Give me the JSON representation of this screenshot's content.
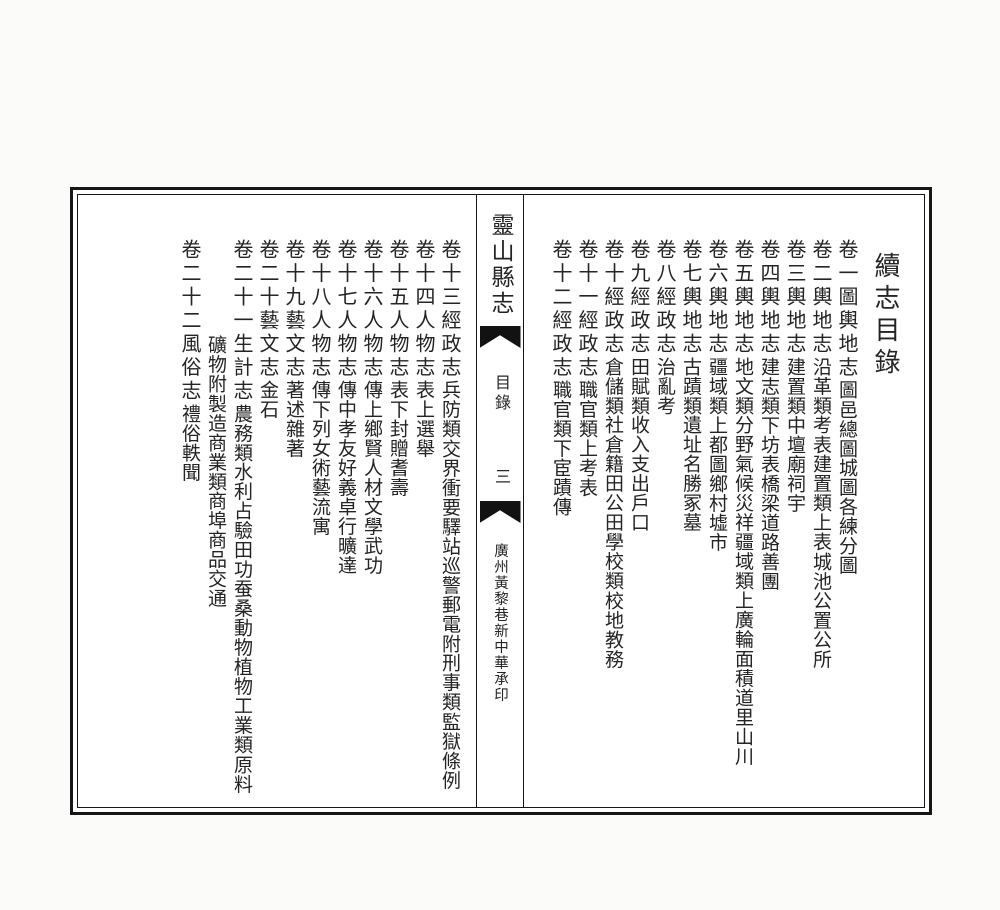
{
  "toc_title": "續志目錄",
  "banxin": {
    "book_title": "靈山縣志",
    "section_label": "目錄",
    "page_number": "三",
    "printer_imprint": "廣州黃黎巷新中華承印"
  },
  "right_page": {
    "entries": [
      {
        "volume": "卷一圖輿地志",
        "groups": [
          [
            "圖"
          ],
          [
            "邑總圖",
            "城圖",
            "各練分圖"
          ]
        ]
      },
      {
        "volume": "卷二輿地志",
        "groups": [
          [
            "沿革類"
          ],
          [
            "考",
            "表"
          ],
          [
            "建置類上"
          ],
          [
            "表",
            "城池",
            "公置",
            "公所"
          ]
        ]
      },
      {
        "volume": "卷三輿地志",
        "groups": [
          [
            "建置類中"
          ],
          [
            "壇廟",
            "祠宇"
          ]
        ]
      },
      {
        "volume": "卷四輿地志",
        "groups": [
          [
            "建志類下"
          ],
          [
            "坊表",
            "橋梁",
            "道路",
            "善團"
          ]
        ]
      },
      {
        "volume": "卷五輿地志",
        "groups": [
          [
            "地文類"
          ],
          [
            "分野",
            "氣候",
            "災祥"
          ],
          [
            "疆域類上"
          ],
          [
            "廣輪面積",
            "道里",
            "山川"
          ]
        ]
      },
      {
        "volume": "卷六輿地志",
        "groups": [
          [
            "疆域類上"
          ],
          [
            "都圖",
            "鄉村",
            "墟市"
          ]
        ]
      },
      {
        "volume": "卷七輿地志",
        "groups": [
          [
            "古蹟類"
          ],
          [
            "遺址",
            "名勝",
            "冢墓"
          ]
        ]
      },
      {
        "volume": "卷八經政志",
        "groups": [
          [
            "治亂考"
          ]
        ]
      },
      {
        "volume": "卷九經政志",
        "groups": [
          [
            "田賦類"
          ],
          [
            "收入",
            "支出",
            "戶口"
          ]
        ]
      },
      {
        "volume": "卷十經政志",
        "groups": [
          [
            "倉儲類"
          ],
          [
            "社倉",
            "籍田",
            "公田"
          ],
          [
            "學校類"
          ],
          [
            "校地",
            "教務"
          ]
        ]
      },
      {
        "volume": "卷十一經政志",
        "groups": [
          [
            "職官類上"
          ],
          [
            "考",
            "表"
          ]
        ]
      },
      {
        "volume": "卷十二經政志",
        "groups": [
          [
            "職官類下"
          ],
          [
            "宦蹟傳"
          ]
        ]
      }
    ]
  },
  "left_page": {
    "entries": [
      {
        "volume": "卷十三經政志",
        "groups": [
          [
            "兵防類"
          ],
          [
            "交界衝要",
            "驛站",
            "巡警",
            "郵電附"
          ],
          [
            "刑事類"
          ],
          [
            "監獄",
            "條例"
          ]
        ]
      },
      {
        "volume": "卷十四人物志",
        "groups": [
          [
            "表上"
          ],
          [
            "選舉"
          ]
        ]
      },
      {
        "volume": "卷十五人物志",
        "groups": [
          [
            "表下"
          ],
          [
            "封贈",
            "耆壽"
          ]
        ]
      },
      {
        "volume": "卷十六人物志",
        "groups": [
          [
            "傳上"
          ],
          [
            "鄉賢",
            "人材",
            "文學",
            "武功"
          ]
        ]
      },
      {
        "volume": "卷十七人物志",
        "groups": [
          [
            "傳中"
          ],
          [
            "孝友",
            "好義",
            "卓行",
            "曠達"
          ]
        ]
      },
      {
        "volume": "卷十八人物志",
        "groups": [
          [
            "傳下"
          ],
          [
            "列女",
            "術藝",
            "流寓"
          ]
        ]
      },
      {
        "volume": "卷十九藝文志",
        "groups": [
          [
            "著述"
          ],
          [
            "雜著"
          ]
        ]
      },
      {
        "volume": "卷二十藝文志",
        "groups": [
          [
            "金石"
          ]
        ]
      },
      {
        "volume": "卷二十一生計志",
        "groups": [
          [
            "農務類"
          ],
          [
            "水利",
            "占驗",
            "田功",
            "蚕桑",
            "動物",
            "植物"
          ],
          [
            "工業類"
          ],
          [
            "原料礦物附",
            "製造"
          ],
          [
            "商業類"
          ],
          [
            "商埠",
            "商品",
            "交通"
          ]
        ]
      },
      {
        "volume": "卷二十二風俗志",
        "groups": [
          [
            "禮俗"
          ],
          [
            "軼聞"
          ]
        ]
      }
    ]
  }
}
